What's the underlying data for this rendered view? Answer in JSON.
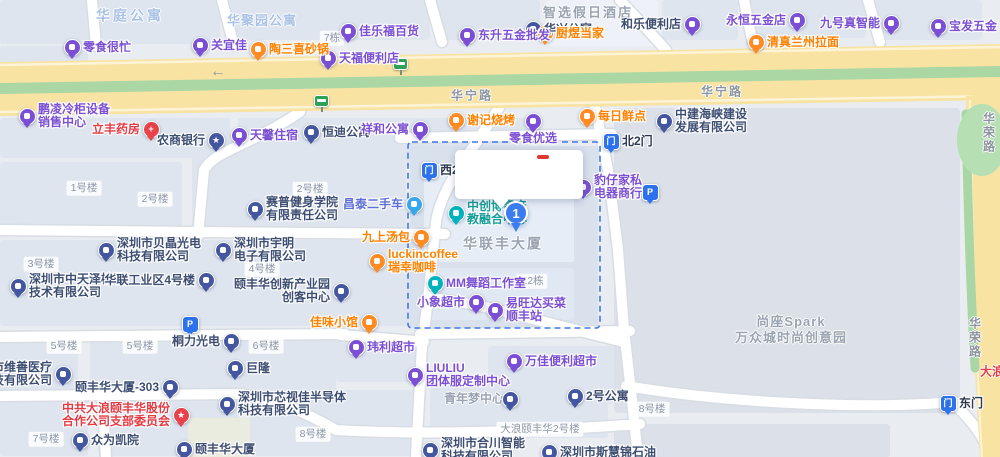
{
  "map": {
    "palette": {
      "bg": "#e9edf2",
      "block": "#dee5ef",
      "block_selected": "#d9e1ed",
      "block_inner": "#e6edf7",
      "block_far": "#dce1e9",
      "road_white": "#ffffff",
      "road_casing": "#d8dde4",
      "road_yellow": "#f8e3a3",
      "road_yellow_edge": "#fdf4d8",
      "road_green_median": "#abd7a5",
      "park_green": "#b7dfb4",
      "selection": "#3f78e8",
      "pins": {
        "purple": "#7a4fd6",
        "orange": "#ff8b22",
        "navy": "#44569f",
        "teal": "#00b2bb",
        "cyan": "#38a6e8",
        "blue": "#2e71ec",
        "gate": "#2e71ec",
        "red": "#e8434b",
        "green": "#2fa057",
        "marker": "#3b7df0"
      },
      "text": {
        "purple": "#7b50d2",
        "orange": "#ff8200",
        "navy": "#3e4e73",
        "gray": "#9aa3b2",
        "roadgray": "#8b949f",
        "lightblue": "#a9c2e6",
        "red": "#e23c44",
        "teal": "#169e98",
        "blue": "#5d6fd6",
        "dark": "#2c3950"
      }
    },
    "selection_box": {
      "x": 408,
      "y": 142,
      "w": 192,
      "h": 186
    },
    "callout": {
      "x": 455,
      "y": 150,
      "w": 128,
      "h": 49,
      "dash": {
        "x": 82,
        "y": 5,
        "w": 12,
        "h": 4,
        "color": "#e0392f"
      }
    },
    "pois": [
      {
        "id": "lingshi-henmang",
        "x": 72,
        "y": 47,
        "pin": "purple",
        "side": "right",
        "lines": [
          "零食很忙"
        ],
        "tc": "purple"
      },
      {
        "id": "guanyijia",
        "x": 200,
        "y": 45,
        "pin": "purple",
        "side": "right",
        "lines": [
          "关宜佳"
        ],
        "tc": "purple"
      },
      {
        "id": "taosanxi-shaguo",
        "x": 258,
        "y": 49,
        "pin": "orange",
        "side": "right",
        "lines": [
          "陶三喜砂锅"
        ],
        "tc": "orange"
      },
      {
        "id": "tianfu-store",
        "x": 328,
        "y": 58,
        "pin": "purple",
        "side": "right",
        "lines": [
          "天福便利店"
        ],
        "tc": "purple"
      },
      {
        "id": "jialefu-store",
        "x": 348,
        "y": 31,
        "pin": "purple",
        "side": "right",
        "lines": [
          "佳乐福百货"
        ],
        "tc": "purple"
      },
      {
        "id": "huaxing-apartment",
        "x": 533,
        "y": 29,
        "pin": "navy",
        "side": "right",
        "lines": [
          "华兴公寓"
        ],
        "tc": "navy"
      },
      {
        "id": "dongsheng-hardware",
        "x": 467,
        "y": 35,
        "pin": "purple",
        "side": "right",
        "lines": [
          "东升五金批发"
        ],
        "tc": "purple"
      },
      {
        "id": "chuyu-dangjia",
        "x": 545,
        "y": 33,
        "pin": "orange",
        "side": "right",
        "lines": [
          "厨煜当家"
        ],
        "tc": "orange"
      },
      {
        "id": "hele-store",
        "x": 692,
        "y": 24,
        "pin": "purple",
        "side": "left",
        "lines": [
          "和乐便利店"
        ],
        "tc": "navy"
      },
      {
        "id": "yongheng-hardware",
        "x": 797,
        "y": 20,
        "pin": "purple",
        "side": "left",
        "lines": [
          "永恒五金店"
        ],
        "tc": "purple"
      },
      {
        "id": "jiuhao-smart",
        "x": 891,
        "y": 23,
        "pin": "purple",
        "side": "left",
        "lines": [
          "九号真智能"
        ],
        "tc": "purple"
      },
      {
        "id": "baofa-hardware",
        "x": 938,
        "y": 26,
        "pin": "purple",
        "side": "right",
        "lines": [
          "宝发五金"
        ],
        "tc": "purple"
      },
      {
        "id": "lanzhou-noodles",
        "x": 756,
        "y": 42,
        "pin": "orange",
        "side": "right",
        "lines": [
          "清真兰州拉面"
        ],
        "tc": "orange"
      },
      {
        "id": "pengling-refrigeration",
        "x": 27,
        "y": 116,
        "pin": "purple",
        "side": "right",
        "lines": [
          "鹏凌冷柜设备",
          "销售中心"
        ],
        "tc": "purple"
      },
      {
        "id": "lifeng-pharmacy",
        "x": 151,
        "y": 129,
        "pin": "red",
        "glyph": "+",
        "side": "left",
        "lines": [
          "立丰药房"
        ],
        "tc": "red"
      },
      {
        "id": "rural-commercial-bank",
        "x": 216,
        "y": 140,
        "pin": "navy",
        "glyph": "★",
        "side": "left",
        "lines": [
          "农商银行"
        ],
        "tc": "navy"
      },
      {
        "id": "tianxin-lodging",
        "x": 239,
        "y": 135,
        "pin": "purple",
        "side": "right",
        "lines": [
          "天馨住宿"
        ],
        "tc": "purple"
      },
      {
        "id": "hengdi-apartment",
        "x": 311,
        "y": 132,
        "pin": "navy",
        "side": "right",
        "lines": [
          "恒迪公寓"
        ],
        "tc": "navy"
      },
      {
        "id": "xianghe-apartment",
        "x": 420,
        "y": 129,
        "pin": "purple",
        "side": "left",
        "lines": [
          "祥和公寓"
        ],
        "tc": "purple"
      },
      {
        "id": "xieji-bbq",
        "x": 456,
        "y": 120,
        "pin": "orange",
        "side": "right",
        "lines": [
          "谢记烧烤"
        ],
        "tc": "orange"
      },
      {
        "id": "lingshi-youxuan",
        "x": 533,
        "y": 121,
        "pin": "purple",
        "side": "below",
        "lines": [
          "零食优选"
        ],
        "tc": "purple"
      },
      {
        "id": "meiri-xiandian",
        "x": 587,
        "y": 116,
        "pin": "orange",
        "side": "right",
        "lines": [
          "每日鲜点"
        ],
        "tc": "orange"
      },
      {
        "id": "north-gate-2",
        "x": 611,
        "y": 141,
        "pin": "gate",
        "glyph": "门",
        "side": "right",
        "lines": [
          "北2门"
        ],
        "tc": "dark"
      },
      {
        "id": "west-gate-2",
        "x": 429,
        "y": 170,
        "pin": "gate",
        "glyph": "门",
        "side": "right",
        "lines": [
          "西2门"
        ],
        "tc": "dark"
      },
      {
        "id": "zhongjian-haixia",
        "x": 664,
        "y": 121,
        "pin": "navy",
        "side": "right",
        "lines": [
          "中建海峡建设",
          "发展有限公司"
        ],
        "tc": "navy"
      },
      {
        "id": "baozai-furniture",
        "x": 583,
        "y": 187,
        "pin": "purple",
        "side": "right",
        "lines": [
          "豹仔家私",
          "电器商行"
        ],
        "tc": "purple"
      },
      {
        "id": "parking-east",
        "x": 650,
        "y": 192,
        "pin": "blue",
        "glyph": "P",
        "side": "none",
        "lines": []
      },
      {
        "id": "zhongchuang-center",
        "x": 456,
        "y": 213,
        "pin": "teal",
        "side": "right",
        "lines": [
          "中创博睿产",
          "教融合中心"
        ],
        "tc": "teal"
      },
      {
        "id": "hualianfeng-tower-label",
        "x": 503,
        "y": 244,
        "kind": "label",
        "lines": [
          "华联丰大厦"
        ],
        "tc": "gray",
        "size": 14,
        "ls": 2
      },
      {
        "id": "mm-dance-studio",
        "x": 435,
        "y": 283,
        "pin": "teal",
        "side": "right",
        "lines": [
          "MM舞蹈工作室"
        ],
        "tc": "purple"
      },
      {
        "id": "badge-e2",
        "x": 532,
        "y": 281,
        "kind": "badge",
        "lines": [
          "E2栋"
        ]
      },
      {
        "id": "xiaoxiang-market",
        "x": 476,
        "y": 302,
        "pin": "purple",
        "side": "left",
        "lines": [
          "小象超市"
        ],
        "tc": "purple"
      },
      {
        "id": "yiwangda-sf-station",
        "x": 495,
        "y": 310,
        "pin": "purple",
        "side": "right",
        "lines": [
          "易旺达买菜",
          "顺丰站"
        ],
        "tc": "purple"
      },
      {
        "id": "jiawei-restaurant",
        "x": 369,
        "y": 322,
        "pin": "orange",
        "side": "left",
        "lines": [
          "佳味小馆"
        ],
        "tc": "orange"
      },
      {
        "id": "luckin-coffee",
        "x": 377,
        "y": 261,
        "pin": "orange",
        "side": "right",
        "lines": [
          "luckincoffee",
          "瑞幸咖啡"
        ],
        "tc": "orange"
      },
      {
        "id": "jiushang-tangbao",
        "x": 421,
        "y": 237,
        "pin": "orange",
        "side": "left",
        "lines": [
          "九上汤包"
        ],
        "tc": "orange"
      },
      {
        "id": "changtai-used-cars",
        "x": 414,
        "y": 204,
        "pin": "cyan",
        "side": "left",
        "lines": [
          "昌泰二手车"
        ],
        "tc": "blue"
      },
      {
        "id": "yifenghua-innovation-park",
        "x": 341,
        "y": 291,
        "pin": "navy",
        "side": "left",
        "lines": [
          "颐丰华创新产业园",
          "创客中心"
        ],
        "tc": "navy"
      },
      {
        "id": "yuming-electronics",
        "x": 223,
        "y": 250,
        "pin": "navy",
        "side": "right",
        "lines": [
          "深圳市宇明",
          "电子有限公司"
        ],
        "tc": "navy"
      },
      {
        "id": "badge-4haolou",
        "x": 262,
        "y": 269,
        "kind": "badge",
        "lines": [
          "4号楼"
        ]
      },
      {
        "id": "beijing-optoelectronics",
        "x": 106,
        "y": 250,
        "pin": "navy",
        "side": "right",
        "lines": [
          "深圳市贝晶光电",
          "科技有限公司"
        ],
        "tc": "navy"
      },
      {
        "id": "badge-3haolou",
        "x": 41,
        "y": 264,
        "kind": "badge",
        "lines": [
          "3号楼"
        ]
      },
      {
        "id": "zhongtianze-testing",
        "x": 18,
        "y": 286,
        "pin": "navy",
        "side": "right",
        "lines": [
          "深圳市中天泽检测",
          "技术有限公司"
        ],
        "tc": "navy"
      },
      {
        "id": "hualian-industrial-4",
        "x": 206,
        "y": 280,
        "pin": "navy",
        "side": "left",
        "lines": [
          "华联工业区4号楼"
        ],
        "tc": "navy"
      },
      {
        "id": "parking-west",
        "x": 190,
        "y": 324,
        "pin": "blue",
        "glyph": "P",
        "side": "none",
        "lines": []
      },
      {
        "id": "saipu-fitness",
        "x": 255,
        "y": 209,
        "pin": "navy",
        "side": "right",
        "lines": [
          "赛普健身学院",
          "有限责任公司"
        ],
        "tc": "navy"
      },
      {
        "id": "badge-1haolou",
        "x": 84,
        "y": 188,
        "kind": "badge",
        "lines": [
          "1号楼"
        ]
      },
      {
        "id": "badge-2haolou-a",
        "x": 155,
        "y": 199,
        "kind": "badge",
        "lines": [
          "2号楼"
        ]
      },
      {
        "id": "badge-2haolou-b",
        "x": 310,
        "y": 189,
        "kind": "badge",
        "lines": [
          "2号楼"
        ]
      },
      {
        "id": "tongli-optoelectronics",
        "x": 231,
        "y": 341,
        "pin": "navy",
        "side": "left",
        "lines": [
          "桐力光电"
        ],
        "tc": "navy"
      },
      {
        "id": "julong",
        "x": 235,
        "y": 368,
        "pin": "navy",
        "side": "right",
        "lines": [
          "巨隆"
        ],
        "tc": "navy"
      },
      {
        "id": "badge-5haolou-a",
        "x": 64,
        "y": 346,
        "kind": "badge",
        "lines": [
          "5号楼"
        ]
      },
      {
        "id": "badge-5haolou-b",
        "x": 140,
        "y": 346,
        "kind": "badge",
        "lines": [
          "5号楼"
        ]
      },
      {
        "id": "badge-6haolou",
        "x": 266,
        "y": 346,
        "kind": "badge",
        "lines": [
          "6号楼"
        ]
      },
      {
        "id": "weili-market",
        "x": 356,
        "y": 347,
        "pin": "purple",
        "side": "right",
        "lines": [
          "玮利超市"
        ],
        "tc": "purple"
      },
      {
        "id": "liuliu-uniform",
        "x": 415,
        "y": 375,
        "pin": "purple",
        "side": "right",
        "lines": [
          "LIULIU",
          "团体服定制中心"
        ],
        "tc": "purple"
      },
      {
        "id": "youth-dream-center",
        "x": 474,
        "y": 399,
        "kind": "label",
        "lines": [
          "青年梦中心"
        ],
        "tc": "gray",
        "size": 12
      },
      {
        "id": "unlabeled-company",
        "x": 510,
        "y": 399,
        "pin": "navy",
        "side": "none",
        "lines": []
      },
      {
        "id": "wanjia-store",
        "x": 514,
        "y": 361,
        "pin": "purple",
        "side": "right",
        "lines": [
          "万佳便利超市"
        ],
        "tc": "purple"
      },
      {
        "id": "apartment-2",
        "x": 575,
        "y": 396,
        "pin": "navy",
        "side": "right",
        "lines": [
          "2号公寓"
        ],
        "tc": "navy"
      },
      {
        "id": "badge-dalang-2haolou",
        "x": 540,
        "y": 429,
        "kind": "badge",
        "lines": [
          "大浪颐丰华2号楼"
        ]
      },
      {
        "id": "badge-8haolou-a",
        "x": 652,
        "y": 409,
        "kind": "badge",
        "lines": [
          "8号楼"
        ]
      },
      {
        "id": "badge-8haolou-b",
        "x": 313,
        "y": 434,
        "kind": "badge",
        "lines": [
          "8号楼"
        ]
      },
      {
        "id": "xinshijia-semiconductor",
        "x": 227,
        "y": 404,
        "pin": "navy",
        "side": "right",
        "lines": [
          "深圳市芯视佳半导体",
          "科技有限公司"
        ],
        "tc": "navy"
      },
      {
        "id": "party-committee",
        "x": 181,
        "y": 415,
        "pin": "red",
        "glyph": "★",
        "side": "left",
        "lines": [
          "中共大浪颐丰华股份",
          "合作公司支部委员会"
        ],
        "tc": "red"
      },
      {
        "id": "zhongwei",
        "x": 80,
        "y": 440,
        "pin": "navy",
        "side": "right",
        "lines": [
          "众为凯院"
        ],
        "tc": "navy"
      },
      {
        "id": "yifenghua-tower",
        "x": 184,
        "y": 449,
        "pin": "navy",
        "side": "right",
        "lines": [
          "颐丰华大厦"
        ],
        "tc": "navy"
      },
      {
        "id": "yifenghua-303",
        "x": 170,
        "y": 387,
        "pin": "navy",
        "side": "left",
        "lines": [
          "颐丰华大厦-303"
        ],
        "tc": "navy"
      },
      {
        "id": "weishan-medical",
        "x": 63,
        "y": 374,
        "pin": "navy",
        "side": "left",
        "lines": [
          "深圳市维善医疗",
          "科技有限公司"
        ],
        "tc": "navy"
      },
      {
        "id": "hechuan-smart-tech",
        "x": 430,
        "y": 450,
        "pin": "navy",
        "side": "right",
        "lines": [
          "深圳市合川智能",
          "科技有限公司"
        ],
        "tc": "navy"
      },
      {
        "id": "sihuijin-oil",
        "x": 549,
        "y": 452,
        "pin": "navy",
        "side": "right",
        "lines": [
          "深圳市斯慧锦石油"
        ],
        "tc": "navy"
      },
      {
        "id": "badge-7haolou",
        "x": 46,
        "y": 439,
        "kind": "badge",
        "lines": [
          "7号楼"
        ]
      },
      {
        "id": "east-gate",
        "x": 948,
        "y": 403,
        "pin": "gate",
        "glyph": "门",
        "side": "right",
        "lines": [
          "东门"
        ],
        "tc": "dark"
      },
      {
        "id": "huating-apartment-label",
        "x": 130,
        "y": 16,
        "kind": "label",
        "lines": [
          "华庭公寓"
        ],
        "tc": "lightblue",
        "size": 14,
        "ls": 3
      },
      {
        "id": "huajuyuan-apartment-label",
        "x": 262,
        "y": 21,
        "kind": "label",
        "lines": [
          "华聚园公寓"
        ],
        "tc": "lightblue",
        "size": 13,
        "ls": 1
      },
      {
        "id": "holiday-inn-express-label",
        "x": 588,
        "y": 13,
        "kind": "label",
        "lines": [
          "智选假日酒店"
        ],
        "tc": "gray",
        "size": 13,
        "ls": 2
      },
      {
        "id": "badge-7dong",
        "x": 332,
        "y": 38,
        "kind": "badge",
        "lines": [
          "7栋"
        ]
      },
      {
        "id": "huaning-road-label-a",
        "x": 472,
        "y": 96,
        "kind": "label",
        "lines": [
          "华宁路"
        ],
        "tc": "roadgray",
        "size": 12,
        "ls": 2
      },
      {
        "id": "huaning-road-label-b",
        "x": 722,
        "y": 92,
        "kind": "label",
        "lines": [
          "华宁路"
        ],
        "tc": "roadgray",
        "size": 12,
        "ls": 2
      },
      {
        "id": "spark-park-label",
        "x": 791,
        "y": 330,
        "kind": "label",
        "lines": [
          "尚座Spark",
          "万众城时尚创意园"
        ],
        "tc": "gray",
        "size": 13,
        "ls": 1
      },
      {
        "id": "huarong-road-label-a",
        "x": 988,
        "y": 133,
        "kind": "label",
        "vertical": true,
        "lines": [
          "华荣路"
        ],
        "tc": "roadgray",
        "size": 12
      },
      {
        "id": "huarong-road-label-b",
        "x": 974,
        "y": 338,
        "kind": "label",
        "vertical": true,
        "lines": [
          "华荣路"
        ],
        "tc": "roadgray",
        "size": 12
      },
      {
        "id": "dalang-road-partial-label",
        "x": 992,
        "y": 372,
        "kind": "label",
        "lines": [
          "大浪"
        ],
        "tc": "red",
        "size": 12
      },
      {
        "id": "bus-stop-a",
        "x": 400,
        "y": 66,
        "kind": "bus"
      },
      {
        "id": "bus-stop-b",
        "x": 321,
        "y": 103,
        "kind": "bus"
      },
      {
        "id": "road-direction-arrow",
        "x": 218,
        "y": 72,
        "kind": "arrow",
        "glyph": "←"
      },
      {
        "id": "selected-result-marker",
        "x": 516,
        "y": 213,
        "kind": "marker",
        "glyph": "1"
      }
    ]
  }
}
